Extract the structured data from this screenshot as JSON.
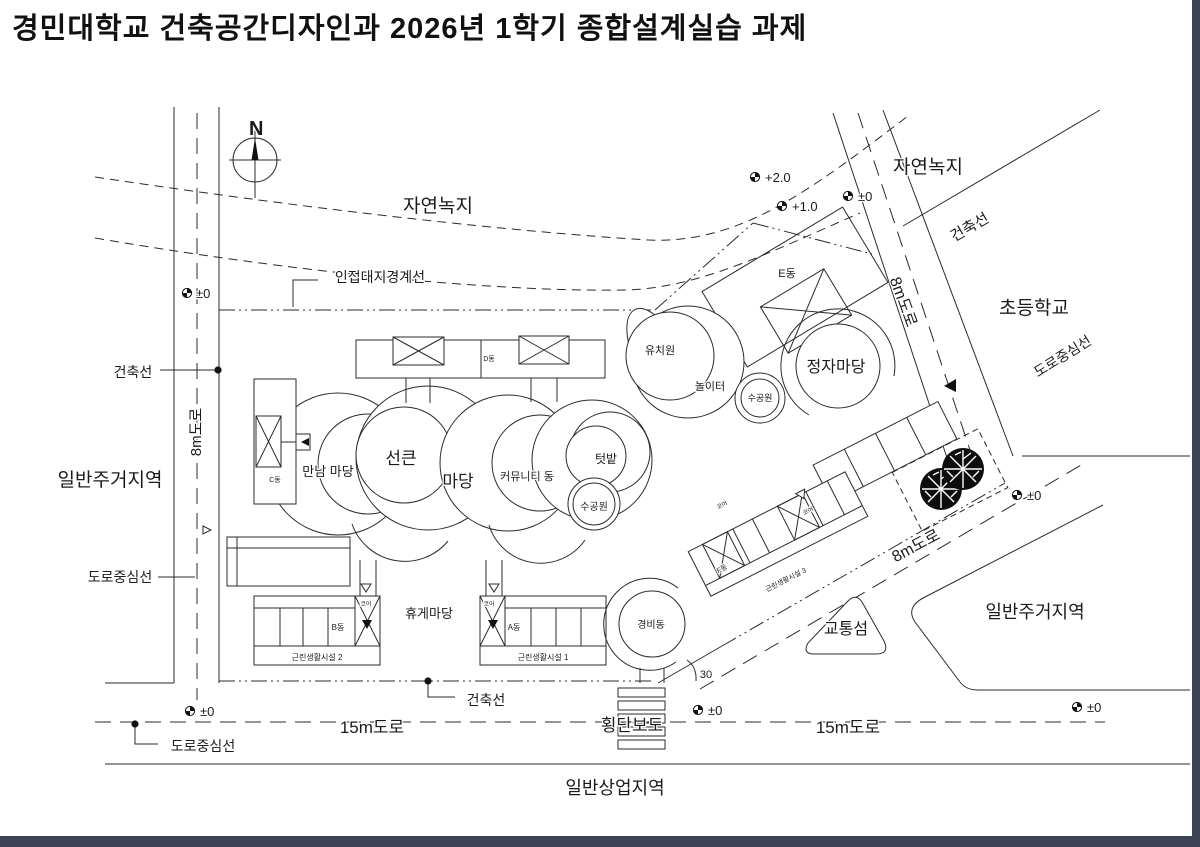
{
  "title": "경민대학교 건축공간디자인과 2026년 1학기 종합설계실습 과제",
  "compass": {
    "label": "N"
  },
  "areas": {
    "natural_green_top": "자연녹지",
    "natural_green_right": "자연녹지",
    "residential_left": "일반주거지역",
    "residential_right": "일반주거지역",
    "commercial_bottom": "일반상업지역",
    "elementary_school": "초등학교"
  },
  "roads": {
    "road8m_left": "8m도로",
    "road8m_ne": "8m도로",
    "road8m_se": "8m도로",
    "road15m_left": "15m도로",
    "road15m_right": "15m도로",
    "crosswalk": "횡단보도",
    "traffic_island": "교통섬",
    "angle_30": "30"
  },
  "lines": {
    "adjacent_boundary": "인접대지경계선",
    "building_line_left": "건축선",
    "building_line_ne": "건축선",
    "building_line_bottom": "건축선",
    "road_center_left": "도로중심선",
    "road_center_right": "도로중심선",
    "road_center_bottom": "도로중심선"
  },
  "levels": {
    "p20": "+2.0",
    "p10": "+1.0",
    "zero_ne": "±0",
    "zero_left": "±0",
    "zero_bottom_left": "±0",
    "zero_bottom_mid": "±0",
    "zero_bottom_right": "±0",
    "zero_right": "±0"
  },
  "buildings": {
    "a": "A동",
    "b": "B동",
    "c": "C동",
    "d": "D동",
    "e": "E동",
    "f": "F동",
    "core": "코어",
    "nf1": "근린생활시설 1",
    "nf2": "근린생활시설 2",
    "nf3": "근린생활시설 3",
    "security": "경비동",
    "community": "커뮤니티 동",
    "kindergarten": "유치원"
  },
  "courtyards": {
    "meeting": "만남 마당",
    "sunken": "선큰",
    "madang": "마당",
    "rest": "휴게마당",
    "pavilion": "정자마당",
    "playground": "놀이터",
    "garden": "텃밭",
    "water1": "수공원",
    "water2": "수공원"
  },
  "colors": {
    "line": "#2b2b2b",
    "frame": "#3d4156",
    "paper": "#ffffff"
  }
}
